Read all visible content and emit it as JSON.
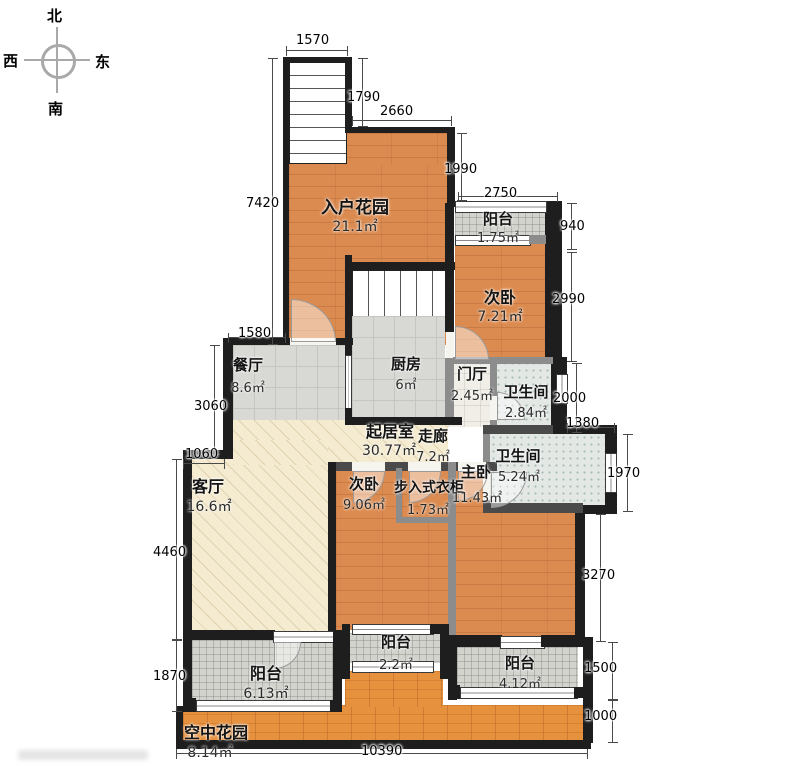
{
  "compass": {
    "north": "北",
    "south": "南",
    "east": "东",
    "west": "西"
  },
  "rooms": {
    "entry_garden": {
      "name": "入户花园",
      "area": "21.1㎡"
    },
    "balcony_top": {
      "name": "阳台",
      "area": "1.75㎡"
    },
    "bedroom_top": {
      "name": "次卧",
      "area": "7.21㎡"
    },
    "kitchen": {
      "name": "厨房",
      "area": "6㎡"
    },
    "foyer": {
      "name": "门厅",
      "area": "2.45㎡"
    },
    "bath_upper": {
      "name": "卫生间",
      "area": "2.84㎡"
    },
    "living": {
      "name": "起居室",
      "area": "30.77㎡"
    },
    "corridor": {
      "name": "走廊",
      "area": "7.2㎡"
    },
    "dining": {
      "name": "餐厅",
      "area": "8.6㎡"
    },
    "lounge": {
      "name": "客厅",
      "area": "16.6㎡"
    },
    "bedroom_mid": {
      "name": "次卧",
      "area": "9.06㎡"
    },
    "closet": {
      "name": "步入式衣柜",
      "area": "1.73㎡"
    },
    "master": {
      "name": "主卧",
      "area": "11.43㎡"
    },
    "bath_lower": {
      "name": "卫生间",
      "area": "5.24㎡"
    },
    "balcony_left": {
      "name": "阳台",
      "area": "6.13㎡"
    },
    "balcony_mid": {
      "name": "阳台",
      "area": "2.2㎡"
    },
    "balcony_right": {
      "name": "阳台",
      "area": "4.12㎡"
    },
    "sky_garden": {
      "name": "空中花园",
      "area": "8.14㎡"
    }
  },
  "dimensions": {
    "stair_top": "1570",
    "stair_right": "1790",
    "garden_top": "2660",
    "garden_right": "1990",
    "balcony_top_w": "2750",
    "balcony_top_h": "940",
    "bedroom_right": "2990",
    "bath_right": "2000",
    "bath_step": "1380",
    "window_right": "1970",
    "master_right": "3270",
    "balcony_br": "1500",
    "strip_right": "1000",
    "bottom": "10390",
    "garden_left": "7420",
    "dining_top": "1580",
    "dining_left": "3060",
    "step_left": "1060",
    "lounge_left": "4460",
    "balcony_left_h": "1870"
  },
  "colors": {
    "wall": "#1e1e1e",
    "partition": "#8c8c8c",
    "wood_floor": "#dc8b50",
    "tile_floor": "#d8d8d4",
    "bath_floor": "#e3e8e5",
    "hall_floor": "#f4ebd1",
    "garden_strip": "#e6913e"
  }
}
